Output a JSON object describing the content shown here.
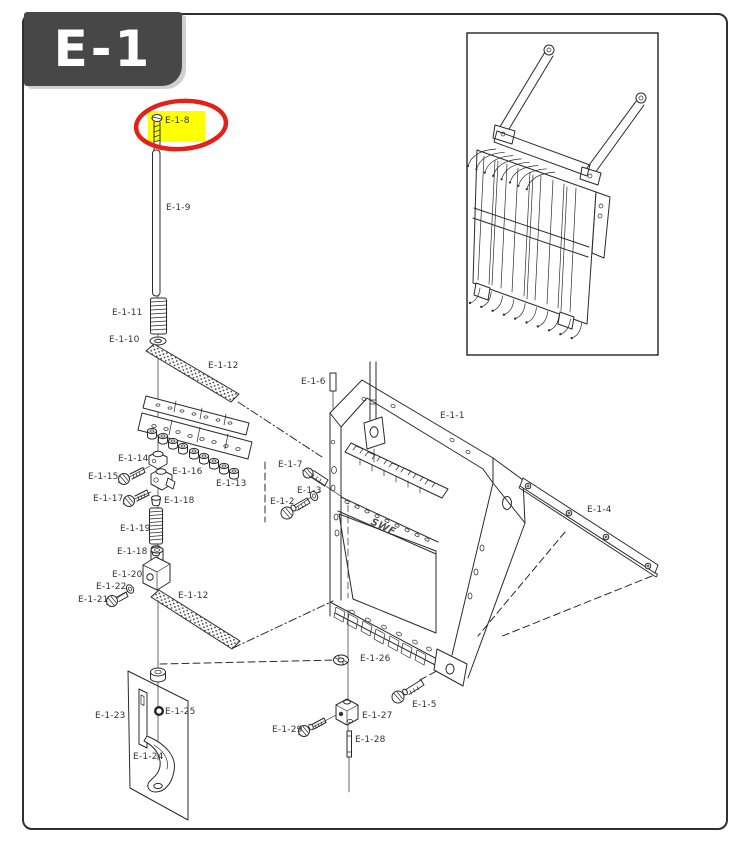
{
  "page": {
    "title": "E-1",
    "frame_logo": "SWF"
  },
  "colors": {
    "line": "#2b2b2b",
    "title_bg": "#474747",
    "title_fg": "#ffffff",
    "border": "#2f2f2f",
    "highlight_fill": "#ffff00",
    "highlight_circle": "#e32119"
  },
  "highlight": {
    "label": "E-1-8"
  },
  "parts": [
    {
      "id": "e-1-8",
      "label": "E-1-8",
      "highlighted": true
    },
    {
      "id": "e-1-9",
      "label": "E-1-9"
    },
    {
      "id": "e-1-11",
      "label": "E-1-11"
    },
    {
      "id": "e-1-10",
      "label": "E-1-10"
    },
    {
      "id": "e-1-12-a",
      "label": "E-1-12"
    },
    {
      "id": "e-1-6",
      "label": "E-1-6"
    },
    {
      "id": "e-1-1",
      "label": "E-1-1"
    },
    {
      "id": "e-1-14",
      "label": "E-1-14"
    },
    {
      "id": "e-1-15",
      "label": "E-1-15"
    },
    {
      "id": "e-1-16",
      "label": "E-1-16"
    },
    {
      "id": "e-1-17",
      "label": "E-1-17"
    },
    {
      "id": "e-1-13",
      "label": "E-1-13"
    },
    {
      "id": "e-1-7",
      "label": "E-1-7"
    },
    {
      "id": "e-1-3",
      "label": "E-1-3"
    },
    {
      "id": "e-1-2",
      "label": "E-1-2"
    },
    {
      "id": "e-1-18-a",
      "label": "E-1-18"
    },
    {
      "id": "e-1-19",
      "label": "E-1-19"
    },
    {
      "id": "e-1-18-b",
      "label": "E-1-18"
    },
    {
      "id": "e-1-20",
      "label": "E-1-20"
    },
    {
      "id": "e-1-22",
      "label": "E-1-22"
    },
    {
      "id": "e-1-21",
      "label": "E-1-21"
    },
    {
      "id": "e-1-12-b",
      "label": "E-1-12"
    },
    {
      "id": "e-1-4",
      "label": "E-1-4"
    },
    {
      "id": "e-1-23",
      "label": "E-1-23"
    },
    {
      "id": "e-1-25",
      "label": "E-1-25"
    },
    {
      "id": "e-1-24",
      "label": "E-1-24"
    },
    {
      "id": "e-1-26",
      "label": "E-1-26"
    },
    {
      "id": "e-1-27",
      "label": "E-1-27"
    },
    {
      "id": "e-1-29",
      "label": "E-1-29"
    },
    {
      "id": "e-1-28",
      "label": "E-1-28"
    },
    {
      "id": "e-1-5",
      "label": "E-1-5"
    }
  ]
}
